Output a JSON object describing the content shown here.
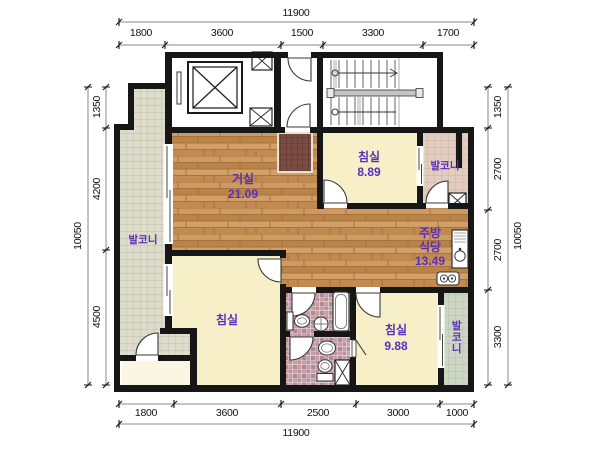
{
  "plan": {
    "dimensions": {
      "top": {
        "total": "11900",
        "segments": [
          "1800",
          "3600",
          "1500",
          "3300",
          "1700"
        ]
      },
      "bottom": {
        "total": "11900",
        "segments": [
          "1800",
          "3600",
          "2500",
          "3000",
          "1000"
        ]
      },
      "left": {
        "total": "10050",
        "segments": [
          "1350",
          "4200",
          "4500"
        ]
      },
      "right": {
        "total": "10050",
        "segments": [
          "1350",
          "2700",
          "2700",
          "3300"
        ]
      }
    },
    "rooms": {
      "living": {
        "name": "거실",
        "area": "21.09"
      },
      "bedroom_top_right": {
        "name": "침실",
        "area": "8.89"
      },
      "bedroom_left": {
        "name": "침실"
      },
      "bedroom_bottom_right": {
        "name": "침실",
        "area": "9.88"
      },
      "kitchen_dining": {
        "name_line1": "주방",
        "name_line2": "식당",
        "area": "13.49"
      },
      "balcony_left": {
        "name": "발코니"
      },
      "balcony_top_right": {
        "name": "발코니"
      },
      "balcony_bottom_right": {
        "name": "발코니"
      }
    },
    "colors": {
      "wall": "#161616",
      "room_label_text": "#5a2fb8",
      "dimension_text": "#111111",
      "wood_floor": "#c59057",
      "bedroom_floor": "#f7efc7",
      "bath_tile": "#c79fa8",
      "balcony_left_tile": "#deddcc",
      "balcony_top_right_tile": "#e2cec1",
      "balcony_bottom_right_tile": "#cdd5c5",
      "entry_tile": "#7b4c41"
    }
  }
}
